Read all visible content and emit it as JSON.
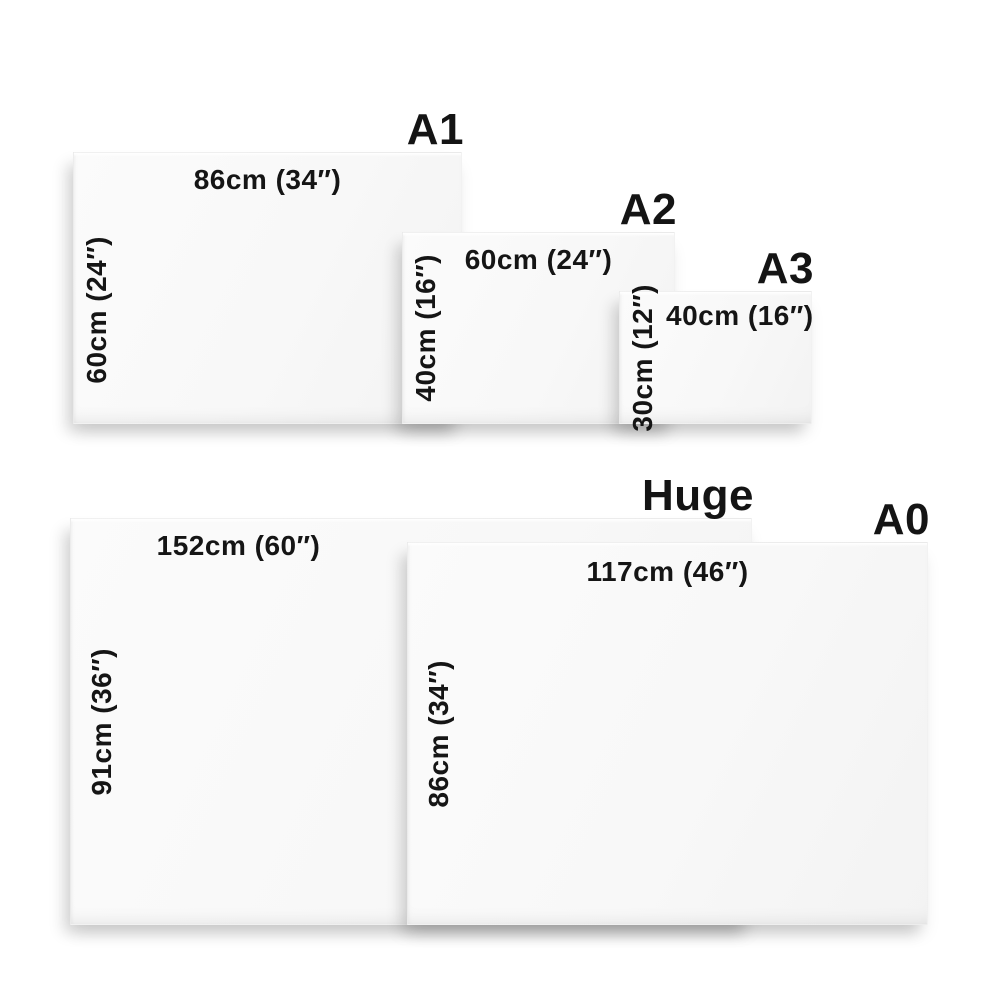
{
  "diagram": {
    "description": "Canvas print size comparison chart",
    "sizes": [
      {
        "id": "a1",
        "name": "A1",
        "width_label": "86cm (34″)",
        "height_label": "60cm (24″)"
      },
      {
        "id": "a2",
        "name": "A2",
        "width_label": "60cm (24″)",
        "height_label": "40cm (16″)"
      },
      {
        "id": "a3",
        "name": "A3",
        "width_label": "40cm (16″)",
        "height_label": "30cm (12″)"
      },
      {
        "id": "huge",
        "name": "Huge",
        "width_label": "152cm (60″)",
        "height_label": "91cm (36″)"
      },
      {
        "id": "a0",
        "name": "A0",
        "width_label": "117cm (46″)",
        "height_label": "86cm (34″)"
      }
    ],
    "colors": {
      "background": "#ffffff",
      "canvas_fill": "#f8f8f8",
      "text": "#151515",
      "shadow": "rgba(0,0,0,0.14)"
    }
  }
}
